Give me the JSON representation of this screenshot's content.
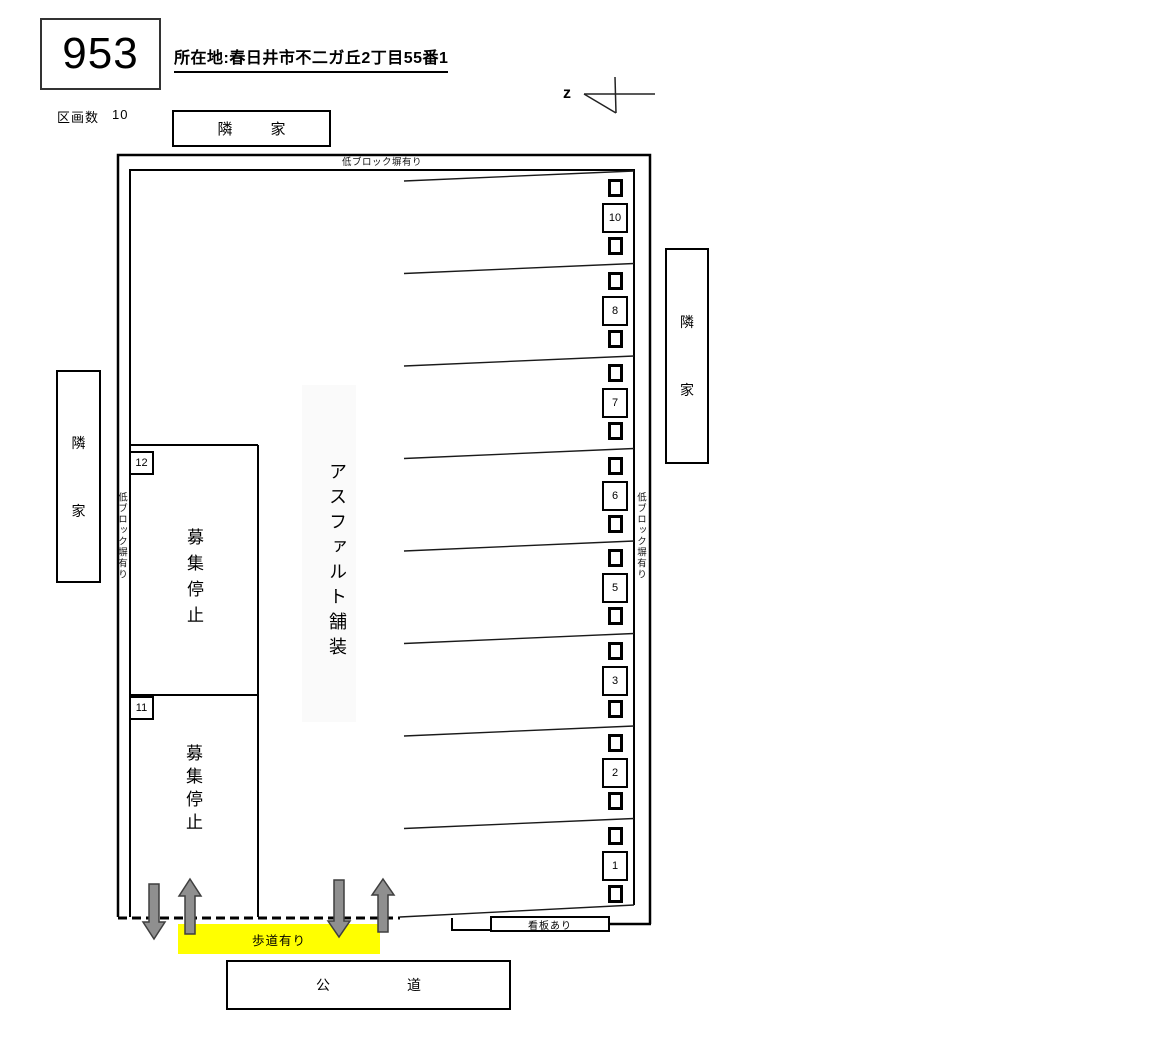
{
  "header": {
    "lot_number": "953",
    "address": "所在地:春日井市不二ガ丘2丁目55番1",
    "parcel_count_label": "区画数",
    "parcel_count": "10"
  },
  "compass": {
    "letter": "z"
  },
  "neighbors": {
    "top": "隣家",
    "left": "隣家",
    "right": "隣家"
  },
  "walls": {
    "top": "低ブロック塀有り",
    "left": "低ブロック塀有り",
    "right": "低ブロック塀有り"
  },
  "surface": {
    "label": "アスファルト舗装"
  },
  "spaces": {
    "right": [
      "10",
      "8",
      "7",
      "6",
      "5",
      "3",
      "2",
      "1"
    ],
    "left": [
      {
        "number": "12",
        "status": "募集停止"
      },
      {
        "number": "11",
        "status": "募集停止"
      }
    ]
  },
  "annotations": {
    "sidewalk": "歩道有り",
    "road": "公道",
    "signboard": "看板あり"
  },
  "colors": {
    "sidewalk_highlight": "#ffff00",
    "arrow_fill": "#8f8f8f",
    "arrow_stroke": "#3f3f3f"
  }
}
